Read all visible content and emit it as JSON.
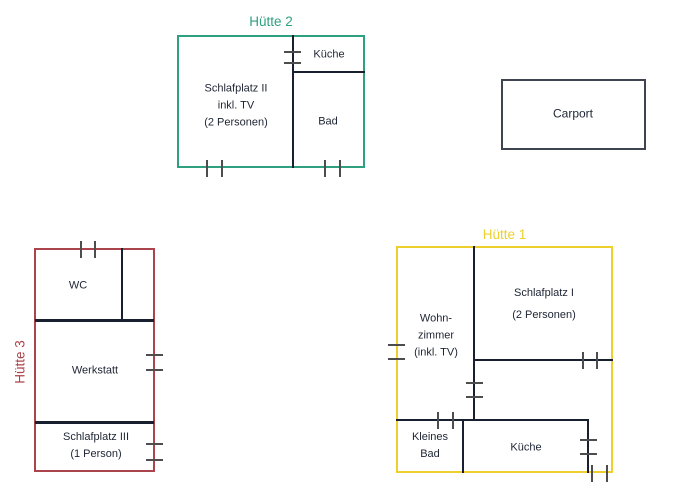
{
  "diagram": {
    "wall_color": "#181f2f",
    "tick_color": "#4d4d4d",
    "text_color": "#1d2433",
    "background": "#ffffff"
  },
  "carport": {
    "label": "Carport",
    "border_color": "#3e4551"
  },
  "huts": {
    "hut1": {
      "title": "Hütte 1",
      "color": "#edd02e",
      "rooms": {
        "living": "Wohn-\nzimmer\n(inkl. TV)",
        "sleep": "Schlafplatz I\n(2 Personen)",
        "small_bath": "Kleines\nBad",
        "kitchen": "Küche"
      }
    },
    "hut2": {
      "title": "Hütte 2",
      "color": "#2fa080",
      "rooms": {
        "sleep": "Schlafplatz II\ninkl. TV\n(2 Personen)",
        "kitchen": "Küche",
        "bath": "Bad"
      }
    },
    "hut3": {
      "title": "Hütte 3",
      "color": "#ab444b",
      "rooms": {
        "wc": "WC",
        "workshop": "Werkstatt",
        "sleep": "Schlafplatz III\n(1 Person)"
      }
    }
  }
}
